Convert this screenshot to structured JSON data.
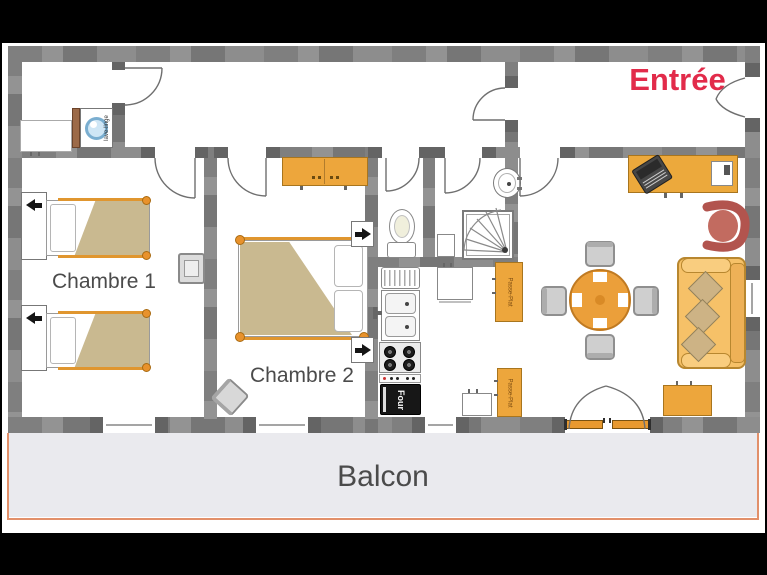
{
  "rooms": {
    "entry": {
      "label": "Entrée"
    },
    "bedroom1": {
      "label": "Chambre 1"
    },
    "bedroom2": {
      "label": "Chambre 2"
    },
    "balcony": {
      "label": "Balcon"
    }
  },
  "appliance_labels": {
    "washing_machine": "lave-linge",
    "oven": "Four",
    "serving_hatch_upper": "Passe-Plat",
    "serving_hatch_lower": "Passe-Plat"
  },
  "colors": {
    "wall": "#8d8d8d",
    "wall_dark": "#646464",
    "furniture_orange": "#eda63c",
    "sofa": "#f6c168",
    "cushion": "#cdb385",
    "blanket": "#c9b990",
    "armchair": "#b2544e",
    "balcony_floor": "#eaeaee",
    "balcony_border": "#e2906a",
    "entry_text": "#e22b4a",
    "room_text": "#4b4b4b",
    "drum": "#cfe6f5",
    "oven": "#171717"
  }
}
